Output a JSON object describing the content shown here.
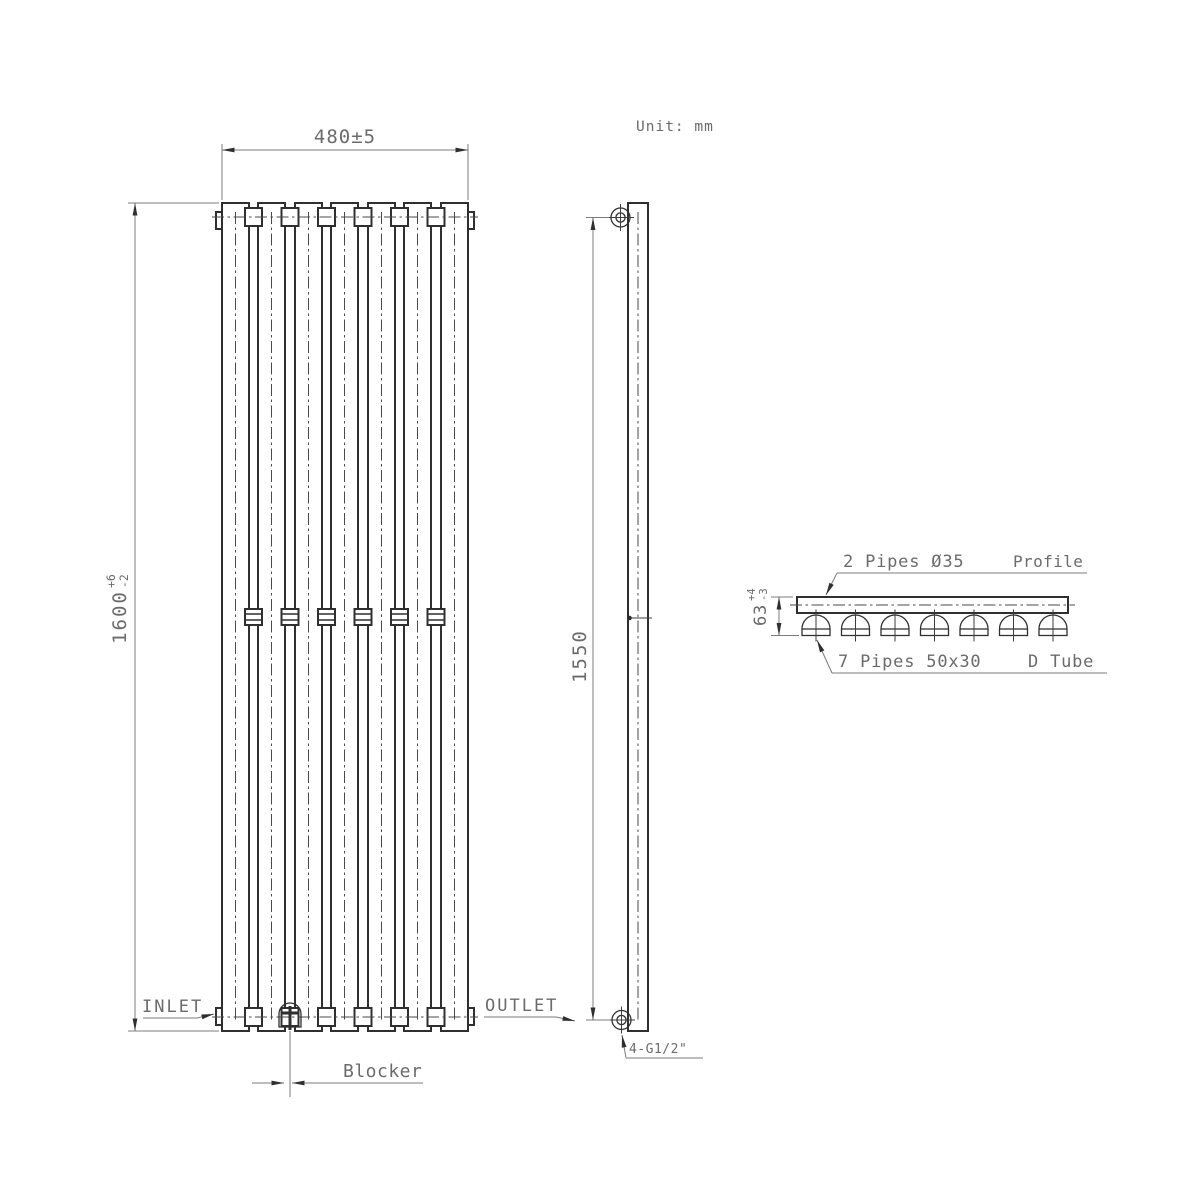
{
  "drawing": {
    "unit_note": "Unit: mm",
    "front_view": {
      "width_dim": "480±5",
      "height_dim_value": "1600",
      "height_tol_plus": "+6",
      "height_tol_minus": "-2",
      "inlet_label": "INLET",
      "outlet_label": "OUTLET",
      "blocker_label": "Blocker",
      "panels_count": 7
    },
    "side_view": {
      "bracket_spacing_dim": "1550",
      "thread_label": "4-G1/2\""
    },
    "profile_view": {
      "pipes_top_label": "2 Pipes Ø35",
      "profile_label": "Profile",
      "depth_dim_value": "63",
      "depth_tol_plus": "+4",
      "depth_tol_minus": "-3",
      "pipes_bottom_label": "7 Pipes 50x30",
      "tube_type_label": "D Tube",
      "tubes_count": 7
    },
    "colors": {
      "object_line": "#2f2f2f",
      "dimension_line": "#7c7c7c",
      "text": "#6b6b6b",
      "background": "#ffffff"
    }
  }
}
